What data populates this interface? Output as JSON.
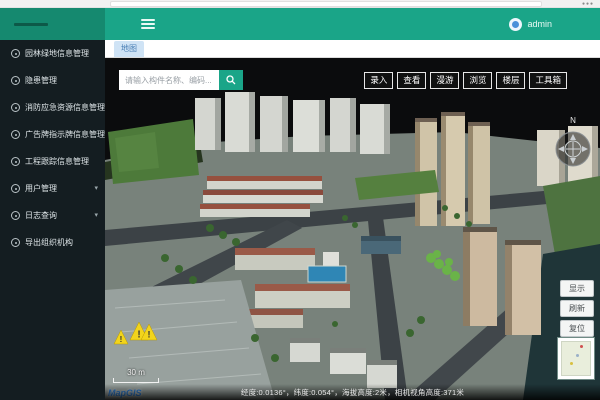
{
  "header": {
    "username": "admin"
  },
  "tabs": [
    {
      "label": "地图",
      "active": true
    }
  ],
  "sidebar": {
    "items": [
      {
        "label": "园林绿地信息管理",
        "expandable": false
      },
      {
        "label": "隐患管理",
        "expandable": false
      },
      {
        "label": "消防应急资源信息管理",
        "expandable": false
      },
      {
        "label": "广告牌指示牌信息管理",
        "expandable": false
      },
      {
        "label": "工程跟踪信息管理",
        "expandable": false
      },
      {
        "label": "用户管理",
        "expandable": true
      },
      {
        "label": "日志查询",
        "expandable": true
      },
      {
        "label": "导出组织机构",
        "expandable": false
      }
    ]
  },
  "map": {
    "search": {
      "placeholder": "请输入构件名称、编码..."
    },
    "toolbar": {
      "buttons": [
        {
          "label": "录入"
        },
        {
          "label": "查看"
        },
        {
          "label": "漫游"
        },
        {
          "label": "浏览"
        },
        {
          "label": "楼层"
        },
        {
          "label": "工具箱"
        }
      ]
    },
    "side_buttons": [
      {
        "label": "显示"
      },
      {
        "label": "刷新"
      },
      {
        "label": "复位"
      }
    ],
    "compass": {
      "north_label": "N"
    },
    "scale": {
      "label": "30 m"
    },
    "brand": "MapGIS",
    "status": "经度:0.0136°，纬度:0.054°，海拔高度:2米，相机视角高度:371米",
    "warning_markers": 3
  },
  "colors": {
    "header_teal": "#1aa588",
    "header_dark_teal": "#15896f",
    "sidebar_bg": "#141d21",
    "tab_active_bg": "#cfe3f5",
    "tab_active_text": "#4a7fb5",
    "warning_yellow": "#f2d41c",
    "brand_blue": "#2f7fd6"
  }
}
